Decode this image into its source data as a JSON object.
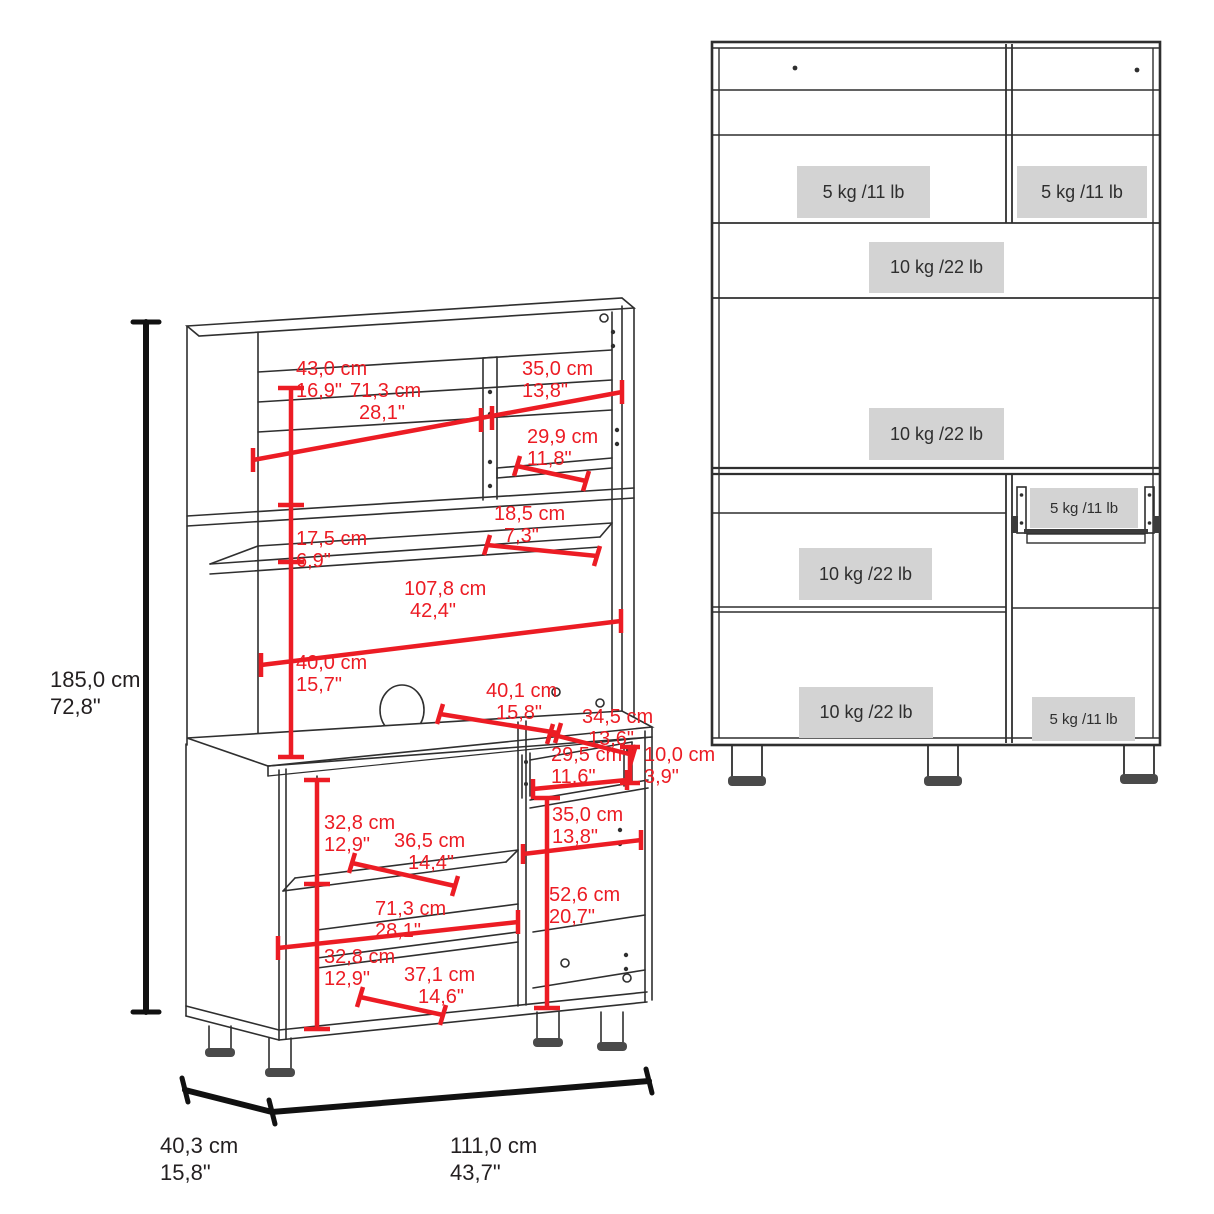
{
  "diagram_title": "kitchen pantry cabinet dimension diagram",
  "colors": {
    "dimension_red": "#ec1c24",
    "line_dark": "#2f2f2f",
    "capacity_box_bg": "#d3d3d3",
    "text_dark": "#231f20"
  },
  "iso_view": {
    "overall": {
      "height": {
        "cm": "185,0 cm",
        "inch": "72,8\""
      },
      "depth": {
        "cm": "40,3 cm",
        "inch": "15,8\""
      },
      "width": {
        "cm": "111,0 cm",
        "inch": "43,7\""
      }
    },
    "dims": [
      {
        "name": "hutch-top-section-height",
        "cm": "43,0 cm",
        "inch": "16,9\""
      },
      {
        "name": "hutch-left-opening-width",
        "cm": "71,3 cm",
        "inch": "28,1\""
      },
      {
        "name": "hutch-right-opening-width",
        "cm": "35,0 cm",
        "inch": "13,8\""
      },
      {
        "name": "hutch-right-shelf-depth",
        "cm": "29,9 cm",
        "inch": "11,8\""
      },
      {
        "name": "hutch-middle-shelf-depth",
        "cm": "18,5 cm",
        "inch": "7,3\""
      },
      {
        "name": "hutch-middle-section-height",
        "cm": "17,5 cm",
        "inch": "6,9\""
      },
      {
        "name": "hutch-interior-width",
        "cm": "107,8 cm",
        "inch": "42,4\""
      },
      {
        "name": "microwave-space-height",
        "cm": "40,0 cm",
        "inch": "15,7\""
      },
      {
        "name": "countertop-depth",
        "cm": "40,1 cm",
        "inch": "15,8\""
      },
      {
        "name": "drawer-width",
        "cm": "34,5 cm",
        "inch": "13,6\""
      },
      {
        "name": "drawer-inner-width",
        "cm": "29,5 cm",
        "inch": "11,6\""
      },
      {
        "name": "drawer-height",
        "cm": "10,0 cm",
        "inch": "3,9\""
      },
      {
        "name": "base-right-opening-width",
        "cm": "35,0 cm",
        "inch": "13,8\""
      },
      {
        "name": "base-upper-section-height",
        "cm": "32,8 cm",
        "inch": "12,9\""
      },
      {
        "name": "base-shelf-depth",
        "cm": "36,5 cm",
        "inch": "14,4\""
      },
      {
        "name": "base-right-section-height",
        "cm": "52,6 cm",
        "inch": "20,7\""
      },
      {
        "name": "base-left-opening-width",
        "cm": "71,3 cm",
        "inch": "28,1\""
      },
      {
        "name": "base-lower-section-height",
        "cm": "32,8 cm",
        "inch": "12,9\""
      },
      {
        "name": "base-bottom-depth",
        "cm": "37,1 cm",
        "inch": "14,6\""
      }
    ]
  },
  "front_view": {
    "capacities": [
      {
        "name": "hutch-left-shelf-capacity",
        "label": "5 kg /11 lb"
      },
      {
        "name": "hutch-right-shelf-capacity",
        "label": "5 kg /11 lb"
      },
      {
        "name": "hutch-middle-shelf-capacity",
        "label": "10 kg /22 lb"
      },
      {
        "name": "hutch-bottom-shelf-capacity",
        "label": "10 kg /22 lb"
      },
      {
        "name": "drawer-capacity",
        "label": "5 kg /11 lb"
      },
      {
        "name": "base-left-shelf-capacity",
        "label": "10 kg /22 lb"
      },
      {
        "name": "base-left-bottom-capacity",
        "label": "10 kg /22 lb"
      },
      {
        "name": "base-right-bottom-capacity",
        "label": "5 kg /11 lb"
      }
    ]
  }
}
